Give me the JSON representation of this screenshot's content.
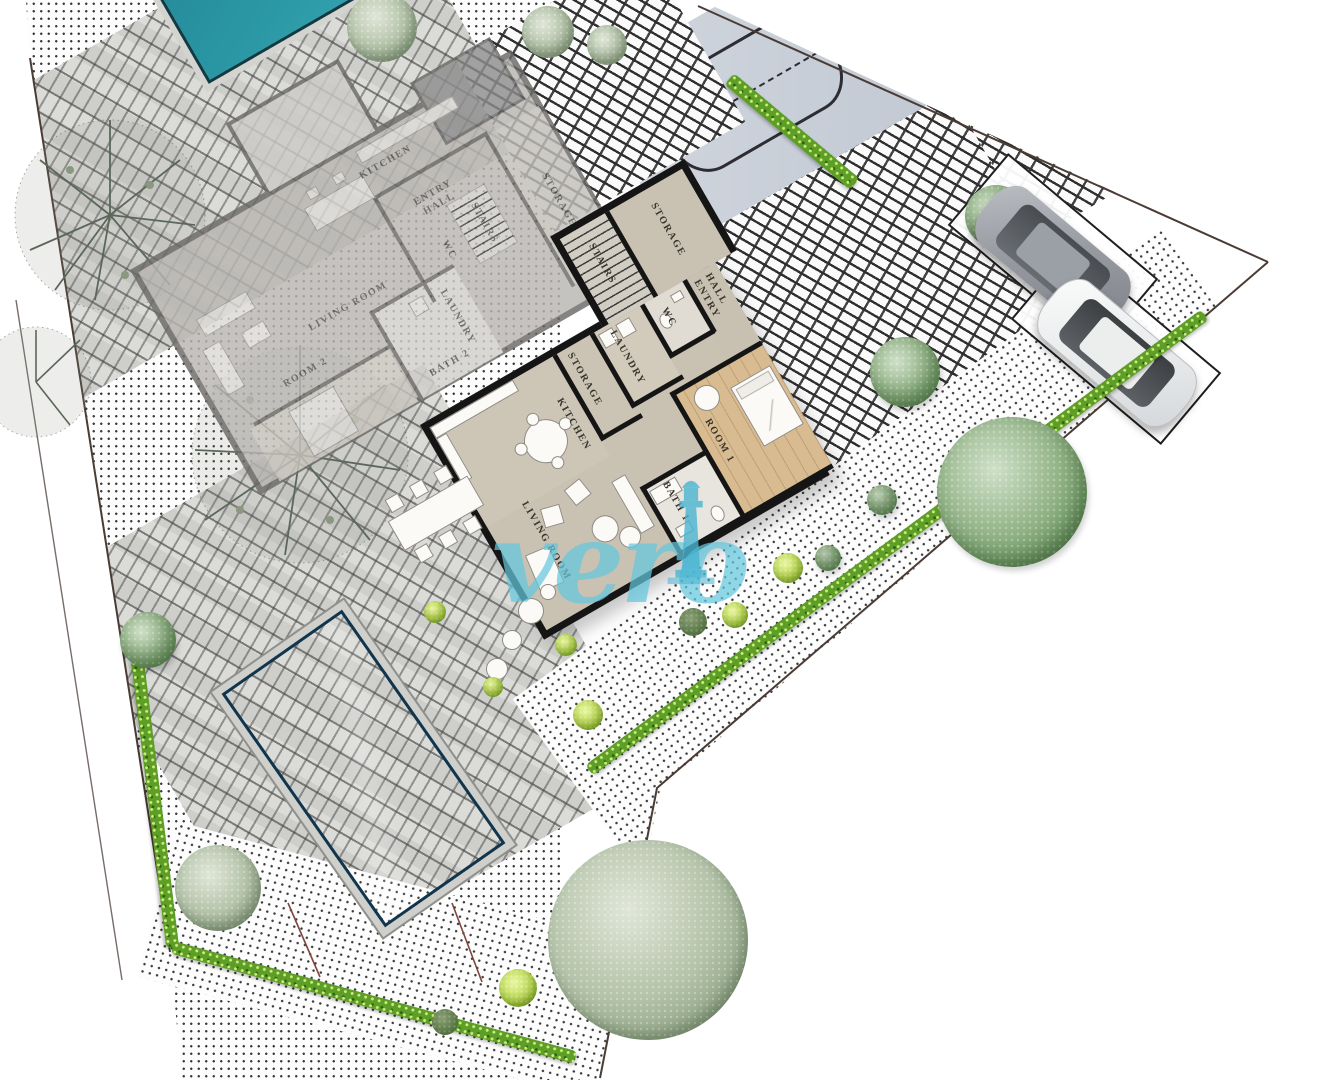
{
  "watermark": {
    "text": "vero",
    "color": "#64c6de",
    "icon": "lighthouse-icon"
  },
  "upper_floor_plan": {
    "rooms": [
      {
        "label": "KITCHEN"
      },
      {
        "label": "ENTRY HALL"
      },
      {
        "label": "WC"
      },
      {
        "label": "STAIRS"
      },
      {
        "label": "STORAGE"
      },
      {
        "label": "LIVING ROOM"
      },
      {
        "label": "LAUNDRY"
      },
      {
        "label": "BATH 2"
      },
      {
        "label": "ROOM 2"
      }
    ]
  },
  "ground_floor_plan": {
    "rooms": [
      {
        "label": "STORAGE"
      },
      {
        "label": "STAIRS"
      },
      {
        "label": "WC"
      },
      {
        "label": "ENTRY HALL"
      },
      {
        "label": "LAUNDRY"
      },
      {
        "label": "STORAGE"
      },
      {
        "label": "KITCHEN"
      },
      {
        "label": "LIVING ROOM"
      },
      {
        "label": "ROOM 1"
      },
      {
        "label": "BATH 1"
      }
    ]
  },
  "site": {
    "colors": {
      "pool_water": "#1d74b4",
      "small_pool_water": "#2a96a4",
      "hedge_green": "#5c9e26",
      "tree_foliage": "#7da472",
      "paving_line": "#2f2f2f",
      "boundary_line": "#4a3c35",
      "wall_black": "#151515"
    },
    "icons": [
      "pool-icon",
      "small-pool-icon",
      "car-icon",
      "parking-space-icon",
      "tree-icon",
      "bush-icon",
      "hedge-icon",
      "bare-tree-icon",
      "lighthouse-icon"
    ]
  }
}
